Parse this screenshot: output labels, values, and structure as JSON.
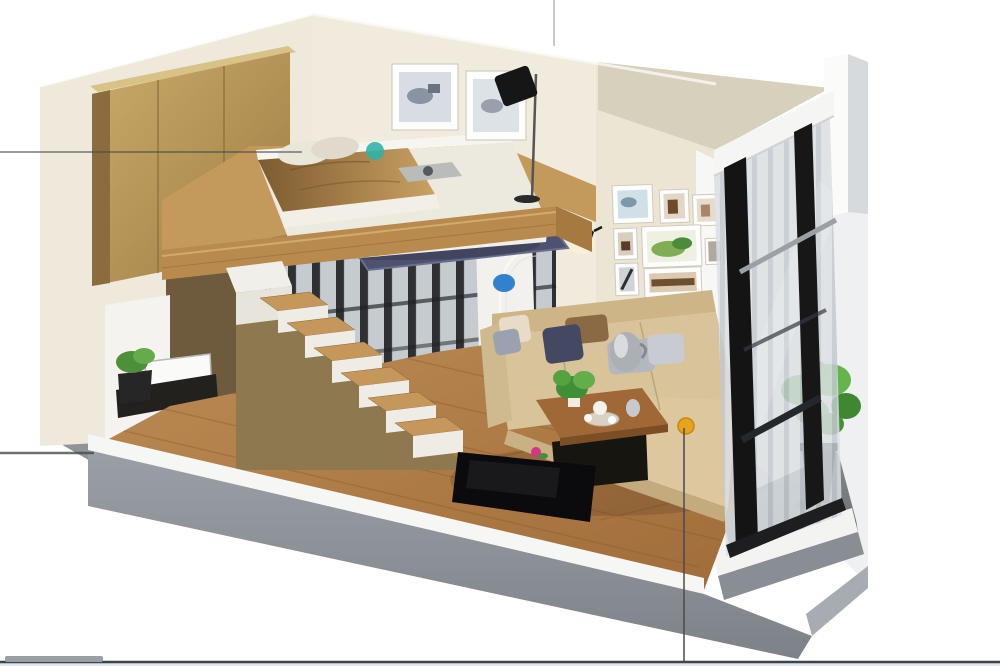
{
  "scene": {
    "type": "3d-apartment-render",
    "description": "Isometric cutaway render of a compact loft apartment: mezzanine bedroom above storage, wooden staircase, living area with L-shaped beige sofa and coffee table, gallery wall of framed pictures, black-framed glazed balcony wall with potted plant",
    "objects": [
      "wardrobe",
      "loft-bed",
      "bed-pillows",
      "gold-duvet",
      "blue-rug",
      "bed-wall-art",
      "floor-lamp",
      "wall-sconce",
      "gallery-wall",
      "staircase",
      "mezzanine-railing",
      "arched-door-outline",
      "sofa",
      "throw-pillows",
      "metal-vase",
      "coffee-table",
      "tea-set",
      "table-plant",
      "tv-panel",
      "pink-flower",
      "left-basin",
      "left-plant",
      "balcony-window-wall",
      "balcony-plant",
      "balcony-floor"
    ]
  },
  "hotspots": {
    "teal": {
      "label": "bedroom-marker",
      "color": "#2bb3a8",
      "x": 375,
      "y": 151
    },
    "blue": {
      "label": "doorway-marker",
      "color": "#2277cc",
      "x": 504,
      "y": 283
    },
    "orange": {
      "label": "living-area-marker",
      "color": "#e7a41f",
      "x": 686,
      "y": 426
    }
  },
  "palette": {
    "wall_cream": "#efe9db",
    "wardrobe_wood": "#c2a15e",
    "floor_wood": "#b07c48",
    "mezzanine_wood": "#b98a4e",
    "stair_wall_tan": "#8d7850",
    "sofa_beige": "#d8c39a",
    "rug_blue": "#4d5270",
    "plant_green": "#55a23e",
    "exterior_gray": "#878d93",
    "window_frame_black": "#141414",
    "guide_line": "#4a4a4a",
    "guide_line_light": "#c9c9c9",
    "scroll_track": "#3f4448",
    "scrollbar_thumb": "#9aa0a4",
    "bottom_strip": "#dfe7ee"
  }
}
